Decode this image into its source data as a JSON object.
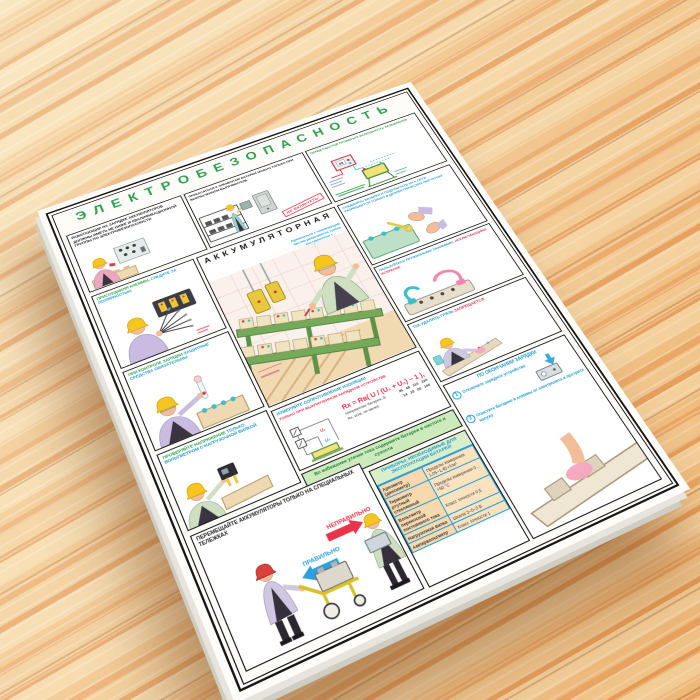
{
  "poster": {
    "title": "ЭЛЕКТРОБЕЗОПАСНОСТЬ",
    "panels": {
      "qualification": {
        "caption": "Работающие на зарядке аккумуляторов должны иметь не ниже III квалификационной группы по электробезопасности"
      },
      "rectifier": {
        "caption": "Прикасаться к элементам батареи можно только при выключенном выпрямителе",
        "stamp": "НЕ ВКЛЮЧАТЬ!"
      },
      "grounding": {
        "caption": "Перед работой проверьте исправность заземления",
        "meter_value": "00"
      },
      "polarity": {
        "caption_start": "Присоединяя клеммы,",
        "caption_em": "следите за полярностью"
      },
      "charge_control": {
        "caption_start": "При контроле зарядки",
        "caption_em": "защитные средства обязательны"
      },
      "voltage": {
        "caption_start": "Проверяйте напряжение",
        "caption_em": "только вольтметром с нагрузочной вилкой"
      },
      "battery_room": {
        "title": "АККУМУЛЯТОРНАЯ",
        "note": "Прикасаться к токоведущим частям разрешается только инструментом с изолирующими рукоятками"
      },
      "gloves": {
        "caption": "Соединять батареи и подключать их к сети разрешается только в диэлектрических перчатках"
      },
      "clamps": {
        "caption_start": "Пользуйтесь пружинными зажимами,",
        "caption_em": "исключающими искрение"
      },
      "dirt": {
        "caption_start": "Так удалять грязь",
        "caption_em": "запрещается"
      },
      "insulation": {
        "title": "Измеряйте сопротивление изоляции",
        "subtitle": "только при выключенном зарядном устройстве",
        "formula": "Rх = Rв( U / (U₁ + U₂) − 1 ),",
        "u1": "U₁",
        "u2": "U₂",
        "table": {
          "row1_label": "Напряжение батареи, В",
          "row1_values": "36   48   110   220",
          "row2_label": "Rх, кОм, не менее",
          "row2_values": "14   25   50   100"
        }
      },
      "cleanliness": {
        "caption": "Во избежание утечки тока содержите батареи в чистоте и сухости"
      },
      "instruments": {
        "title": "ПРИБОРЫ, НЕОБХОДИМЫЕ ДЛЯ ЭКСПЛУАТАЦИИ БАТАРЕЙ",
        "rows": [
          {
            "name": "Ареометр (денсиметр)",
            "spec": "Пределы измерения 1,05–1,40 г/см³"
          },
          {
            "name": "Термометр ртутный стеклянный",
            "spec": "Пределы измерения 0…+50 °С"
          },
          {
            "name": "Вольтметр переносной постоянного тока",
            "spec": "Класс точности 0,5"
          },
          {
            "name": "Нагрузочная вилка",
            "spec": "Шкала 3–0–3 В"
          },
          {
            "name": "Ампервольтметр",
            "spec": "Класс точности 1"
          }
        ]
      },
      "after_charge": {
        "title": "ПО ОКОНЧАНИИ ЗАРЯДКИ",
        "step1_num": "1",
        "step1": "Отключите зарядное устройство",
        "step2_num": "2",
        "step2": "Очистите батарею и клеммы от электролита и протрите насухо"
      },
      "trolley": {
        "caption": "Перемещайте аккумуляторы только на специальных тележках",
        "wrong_label": "НЕПРАВИЛЬНО",
        "right_label": "ПРАВИЛЬНО"
      }
    }
  }
}
